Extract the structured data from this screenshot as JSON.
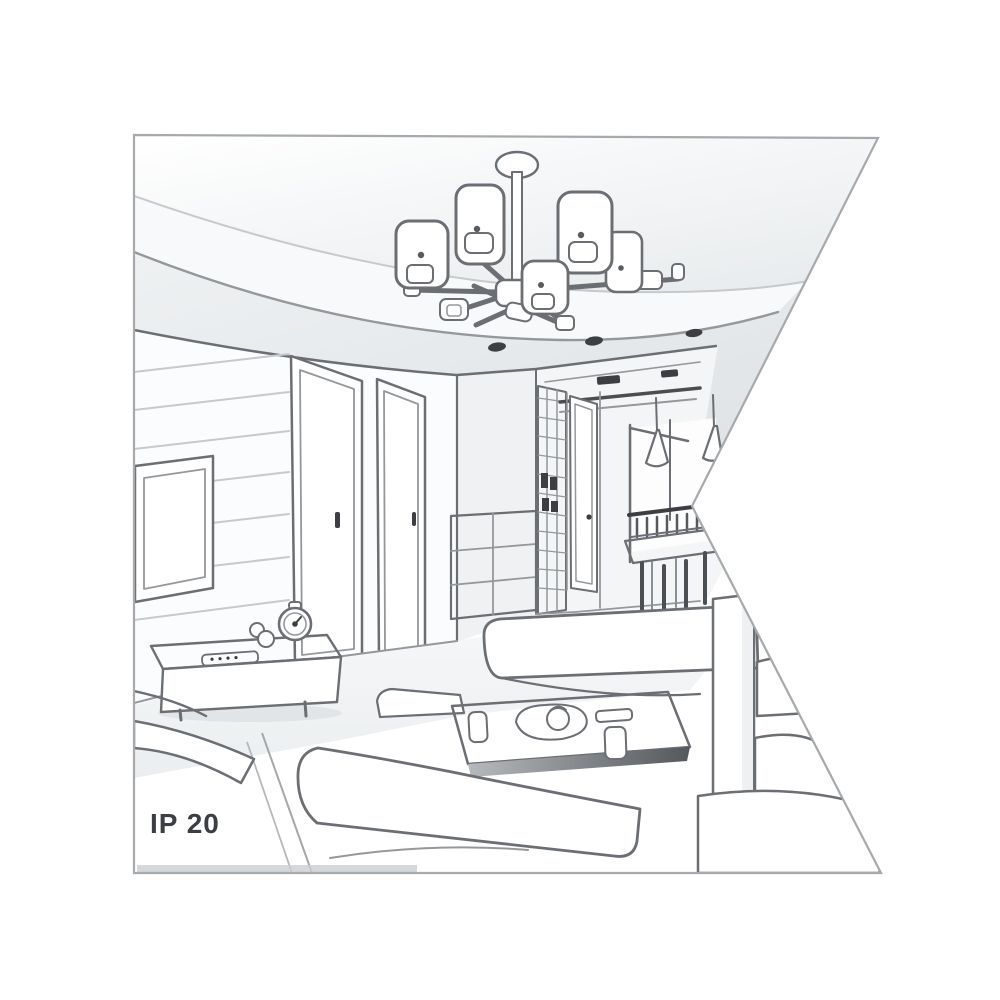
{
  "page": {
    "background": "#ffffff"
  },
  "illustration": {
    "caption": "IP 20",
    "style": "grayscale line-art interior perspective drawing",
    "objects": [
      "ceiling-lamp",
      "lamp-shades",
      "recessed-spotlights",
      "ceiling-vents",
      "tv",
      "tv-wall-panels",
      "tv-stand",
      "remote-control",
      "figurine",
      "table-clock",
      "door-left",
      "door-right",
      "hallway-door",
      "drawer-cabinet",
      "lattice-shelf",
      "pendant-lamps",
      "dining-table",
      "dining-chairs",
      "window-frame",
      "sofa-left-armrest",
      "sofa-back",
      "sofa-right",
      "sofa-front",
      "coffee-table",
      "tray-with-teapot",
      "cups",
      "floor"
    ]
  },
  "colors": {
    "line": "#6b6e72",
    "line_mid": "#94989b",
    "line_light": "#c6cacc",
    "line_dark": "#3c3e41",
    "border": "#a6aaad",
    "caption_text": "#3b3e42",
    "page_bg": "#ffffff",
    "shade_light": "#eef0f2",
    "shade_mid": "#e1e4e7"
  }
}
